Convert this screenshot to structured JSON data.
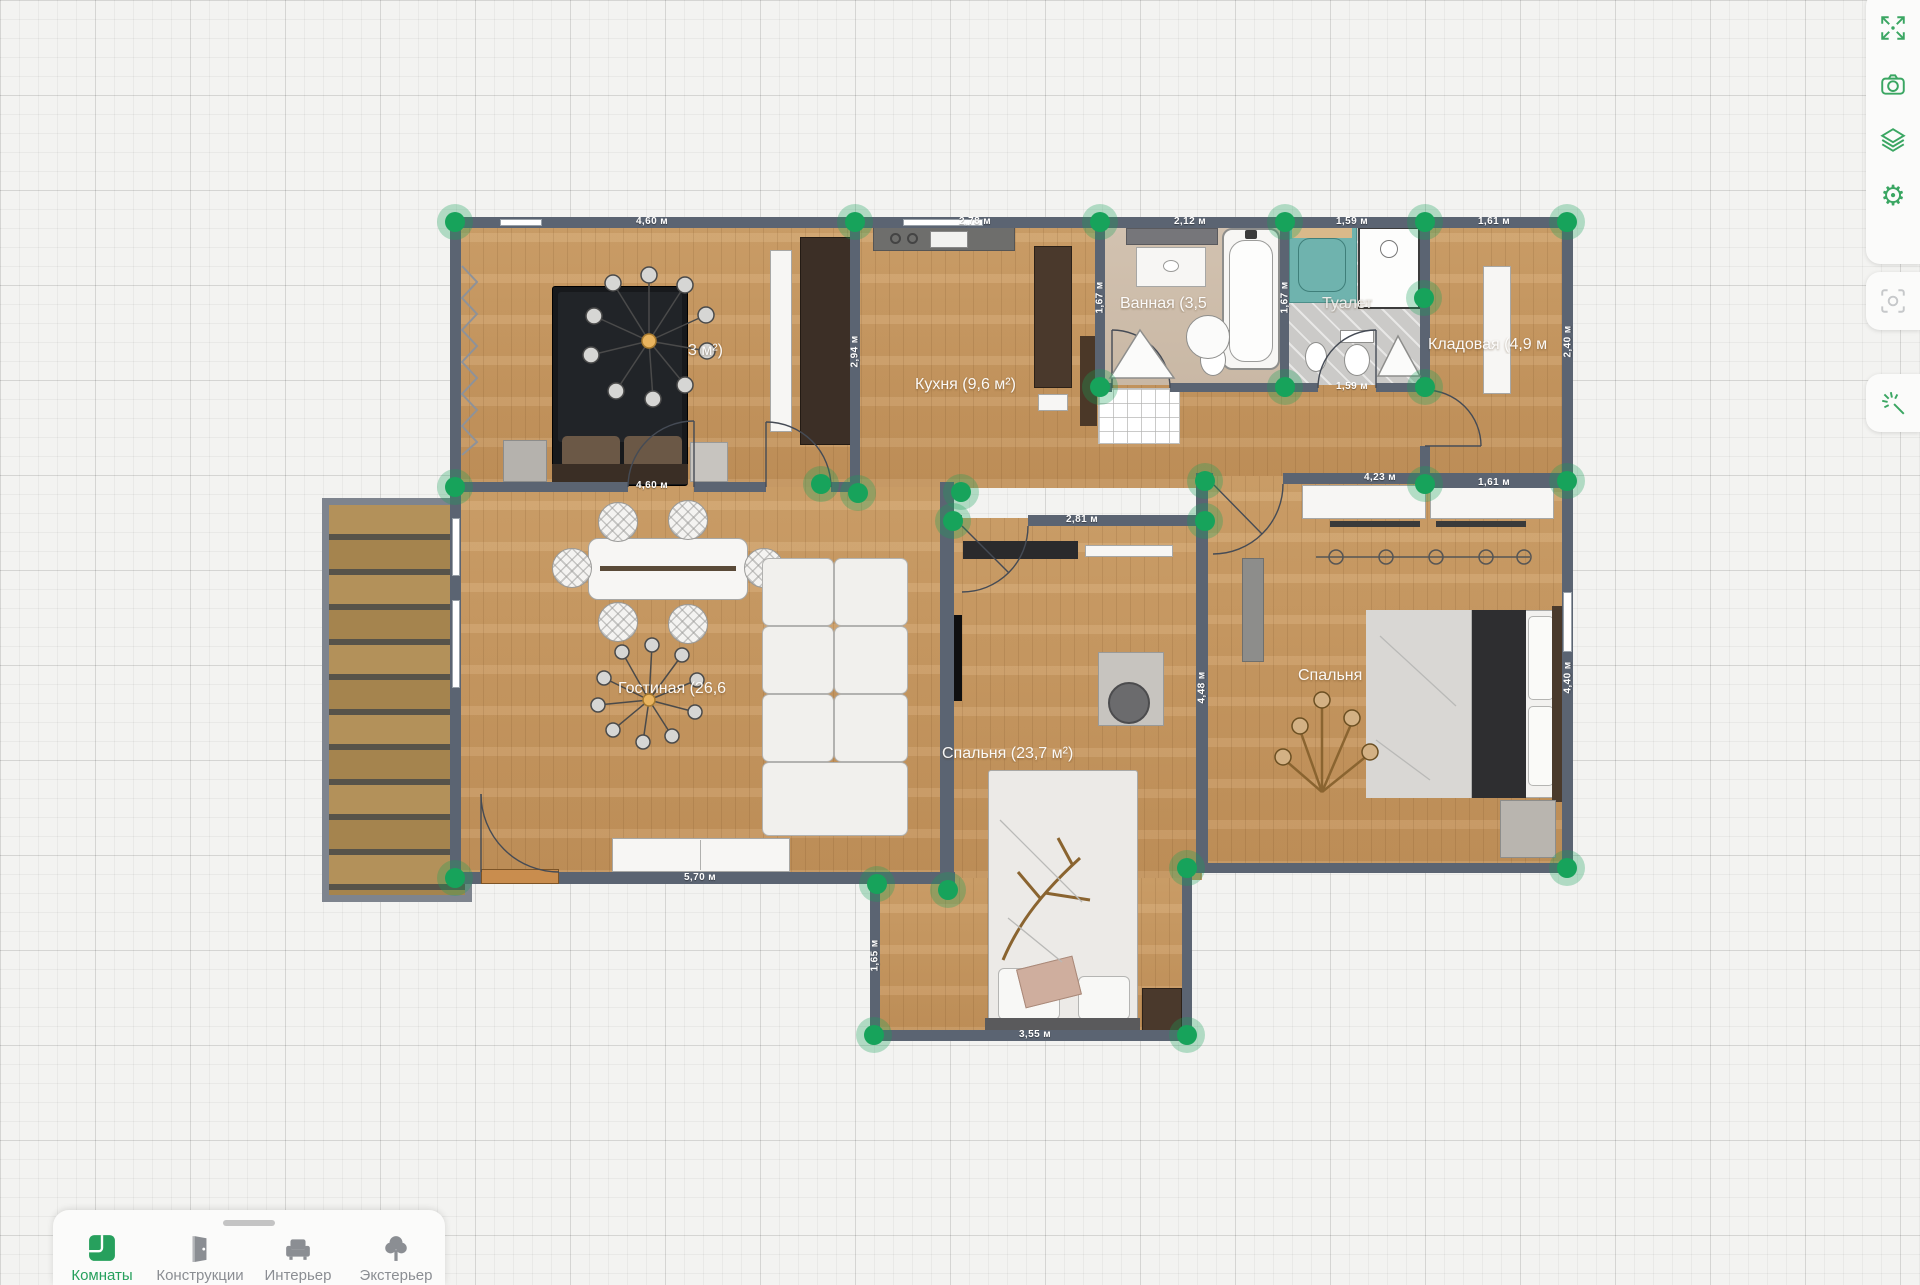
{
  "plan": {
    "room_labels": {
      "bedroom_small": "3 м²)",
      "kitchen": "Кухня (9,6 м²)",
      "bathroom": "Ванная (3,5",
      "toilet": "Туалет",
      "storage": "Кладовая (4,9 м",
      "living": "Гостиная (26,6",
      "bedroom_main": "Спальня (23,7 м²)",
      "bedroom_right": "Спальня"
    },
    "dims": [
      "4,60 м",
      "2,78 м",
      "2,12 м",
      "1,59 м",
      "1,61 м",
      "1,67 м",
      "1,67 м",
      "1,59 м",
      "2,40 м",
      "2,94 м",
      "4,60 м",
      "1,61 м",
      "4,23 м",
      "2,81 м",
      "4,48 м",
      "4,40 м",
      "5,70 м",
      "1,65 м",
      "3,55 м"
    ]
  },
  "sidebar": {
    "buttons": [
      {
        "icon": "fit-screen"
      },
      {
        "icon": "camera"
      },
      {
        "icon": "layers"
      },
      {
        "icon": "settings-gear"
      },
      {
        "icon": "screenshot-focus"
      },
      {
        "icon": "magic-wand"
      }
    ]
  },
  "toolbar": {
    "tabs": [
      {
        "label": "Комнаты",
        "active": true
      },
      {
        "label": "Конструкции",
        "active": false
      },
      {
        "label": "Интерьер",
        "active": false
      },
      {
        "label": "Экстерьер",
        "active": false
      }
    ]
  },
  "colors": {
    "accent_green": "#27a05d",
    "wall": "#5b6472",
    "wood_floor": "#cb9d66",
    "vertex_handle": "#17a35b"
  }
}
